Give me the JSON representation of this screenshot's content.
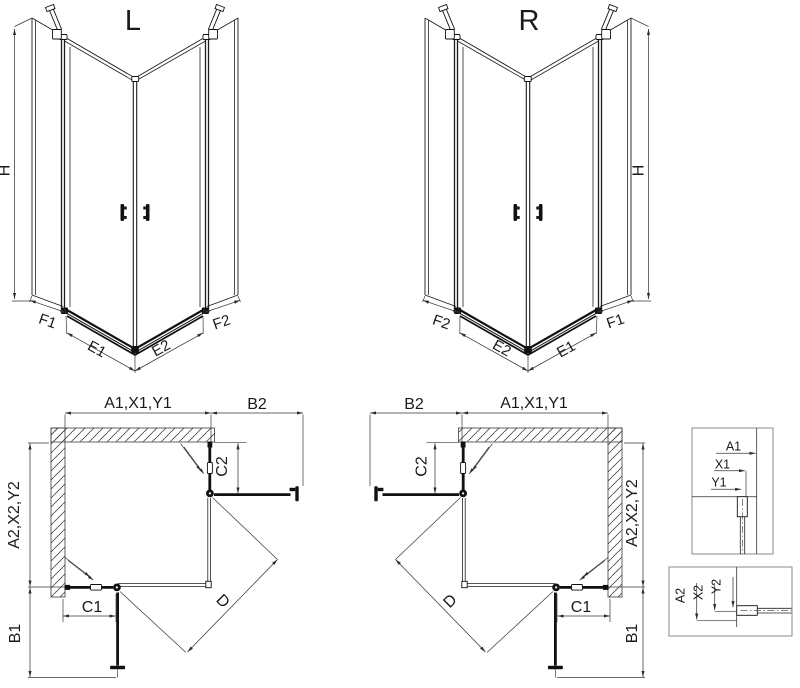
{
  "page": {
    "background": "#ffffff",
    "line_color": "#1c1c1c",
    "dimension_color": "#383838",
    "hatch_color": "#4a4a4a"
  },
  "views": {
    "perspective_left": {
      "title": "L",
      "height_label": "H",
      "segment_labels": {
        "f1": "F1",
        "e1": "E1",
        "e2": "E2",
        "f2": "F2"
      }
    },
    "perspective_right": {
      "title": "R",
      "height_label": "H",
      "segment_labels": {
        "f2": "F2",
        "e2": "E2",
        "e1": "E1",
        "f1": "F1"
      }
    },
    "plan_left": {
      "top_width_label": "A1,X1,Y1",
      "door_top_width_label": "B2",
      "side_depth_label": "A2,X2,Y2",
      "door_side_width_label": "B1",
      "fixed_bottom_label": "C1",
      "fixed_right_label": "C2",
      "diagonal_label": "D"
    },
    "plan_right": {
      "top_width_label": "A1,X1,Y1",
      "door_top_width_label": "B2",
      "side_depth_label": "A2,X2,Y2",
      "door_side_width_label": "B1",
      "fixed_bottom_label": "C1",
      "fixed_right_label": "C2",
      "diagonal_label": "D"
    },
    "detail_wall_top": {
      "a1": "A1",
      "x1": "X1",
      "y1": "Y1"
    },
    "detail_wall_side": {
      "a2": "A2",
      "x2": "X2",
      "y2": "Y2"
    }
  }
}
